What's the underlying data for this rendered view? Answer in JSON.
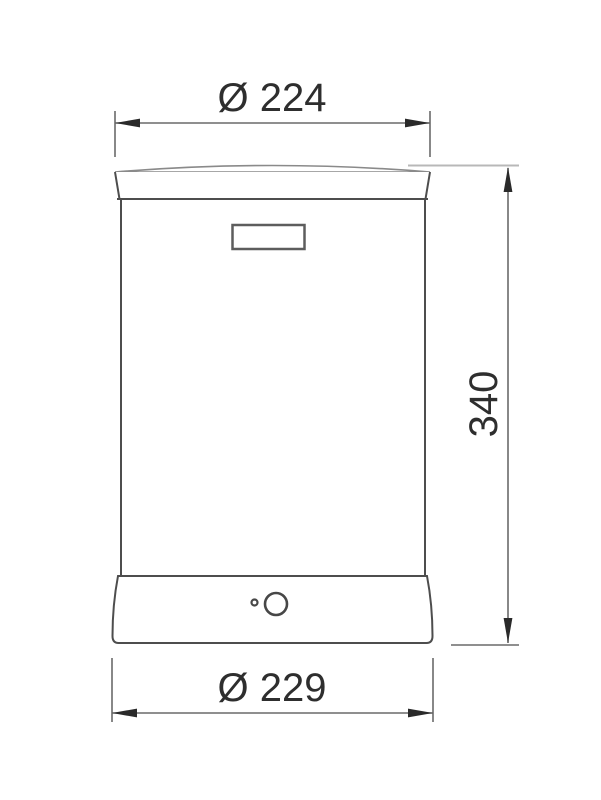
{
  "drawing": {
    "type": "technical-dimension-drawing",
    "view": "front",
    "dimensions": {
      "top_diameter": {
        "label": "Ø 224",
        "value": 224,
        "symbol": "Ø"
      },
      "height": {
        "label": "340",
        "value": 340
      },
      "bottom_diameter": {
        "label": "Ø 229",
        "value": 229,
        "symbol": "Ø"
      }
    },
    "colors": {
      "background": "#ffffff",
      "outline": "#4d4d4d",
      "rim": "#8a8a8a",
      "dimension_line": "#6a6a6a",
      "light_extension": "#b8b8b8",
      "arrowhead": "#2a2a2a",
      "text": "#2e2e2e"
    }
  }
}
